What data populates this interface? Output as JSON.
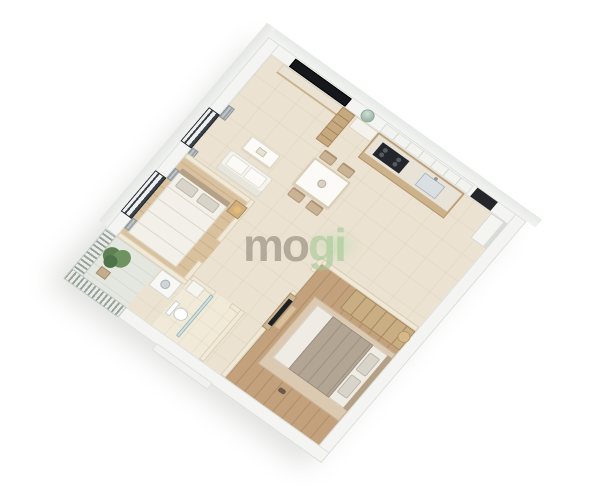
{
  "image": {
    "type": "3d-isometric-floorplan-render",
    "subject": "two-bedroom apartment cutaway dollhouse view",
    "background_color": "#ffffff"
  },
  "watermark": {
    "text": "mogi",
    "part1": "mo",
    "part2": "gi",
    "text_color": "#7a7164",
    "accent_color": "#a5c896"
  },
  "palette": {
    "exterior_wall": "#f4f5f2",
    "interior_wall": "#f1e9d8",
    "floor_tile_cream": "#ebe2d1",
    "wood_floor_light": "#d9c19e",
    "wood_floor_dark": "#c2a17c",
    "cabinet_wood": "#c9ad83",
    "tv_black": "#17191c",
    "curtain_gray": "#a7aeb1",
    "plant_green": "#5d8152",
    "glass_blue": "#bad6da",
    "railing_gray": "#97a09a"
  },
  "rooms": [
    {
      "name": "bedroom-1",
      "features": [
        "double bed",
        "nightstand with lamp",
        "two windows with gray curtains",
        "wood floor"
      ]
    },
    {
      "name": "living-room",
      "features": [
        "wall-mounted tv",
        "tv console",
        "white sofa",
        "coffee table",
        "tall wood shelf"
      ]
    },
    {
      "name": "entry",
      "features": [
        "round mirror",
        "shoe cabinet"
      ]
    },
    {
      "name": "dining-area",
      "features": [
        "white dining table",
        "four beige chairs"
      ]
    },
    {
      "name": "kitchen",
      "features": [
        "counter with cooktop",
        "sink",
        "white upper cabinets",
        "fridge",
        "dark doorway niche"
      ]
    },
    {
      "name": "bathroom",
      "features": [
        "toilet",
        "glass shower screen",
        "vanity"
      ]
    },
    {
      "name": "laundry-nook",
      "features": [
        "washing machine"
      ]
    },
    {
      "name": "bedroom-2",
      "features": [
        "double bed with taupe blanket",
        "wall tv in niche",
        "wardrobe",
        "rug",
        "round stool"
      ]
    },
    {
      "name": "balcony",
      "features": [
        "slatted railing",
        "potted plant"
      ]
    }
  ]
}
